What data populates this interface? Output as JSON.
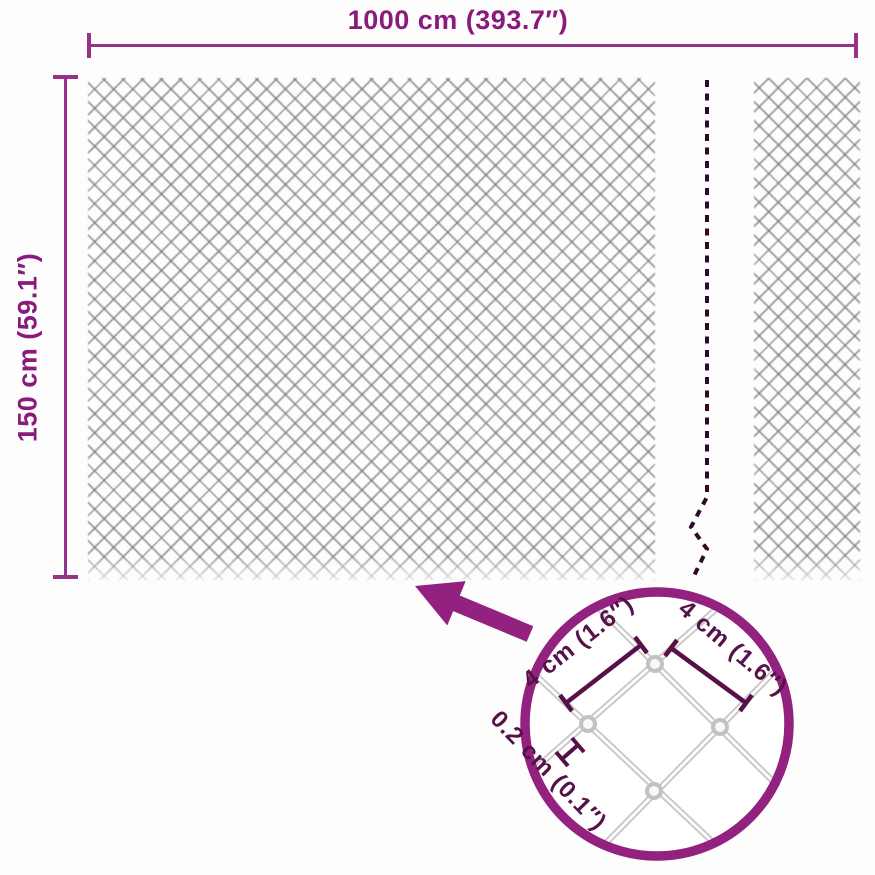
{
  "product_diagram": {
    "title": "chain-link fence dimension diagram",
    "width_label": "1000 cm (393.7″)",
    "height_label": "150 cm (59.1″)",
    "detail": {
      "mesh_opening_left": "4 cm (1.6″)",
      "mesh_opening_right": "4 cm (1.6″)",
      "wire_thickness": "0.2 cm (0.1″)"
    },
    "colors": {
      "accent_purple": "#8A1A7B",
      "dimension_line_purple": "#963288",
      "detail_dim_purple": "#551148",
      "break_dash_dark": "#2E0A29",
      "mesh_gray": "#767676",
      "wire_gray": "#C9C9C9"
    },
    "icons": {
      "arrow": "zoom-arrow",
      "break_line": "length-break-dashed-line",
      "magnifier": "detail-magnifier-circle"
    }
  }
}
